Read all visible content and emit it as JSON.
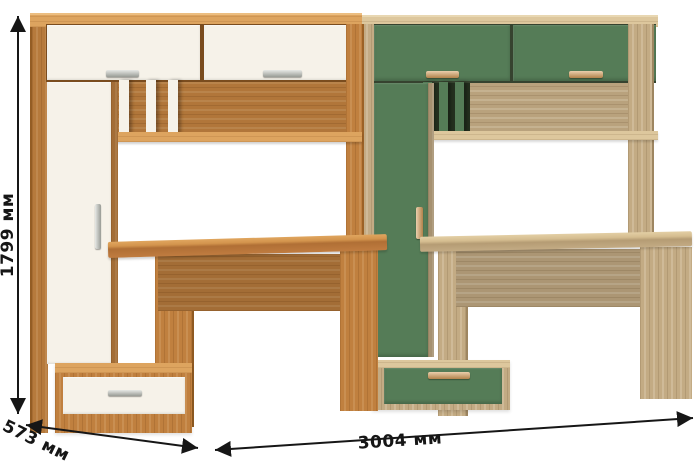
{
  "dimensions": {
    "height": "1799 мм",
    "depth": "573 мм",
    "width": "3004 мм"
  },
  "colors": {
    "golden_oak": "#c0803f",
    "golden_oak_light": "#dda45f",
    "light_oak": "#c3ab84",
    "light_oak_light": "#ddc79d",
    "green": "#557c57",
    "white_panel": "#f6f2e9",
    "metal_handle": "#c3c7bf",
    "wood_handle": "#d9a768",
    "annotation": "#161616"
  }
}
